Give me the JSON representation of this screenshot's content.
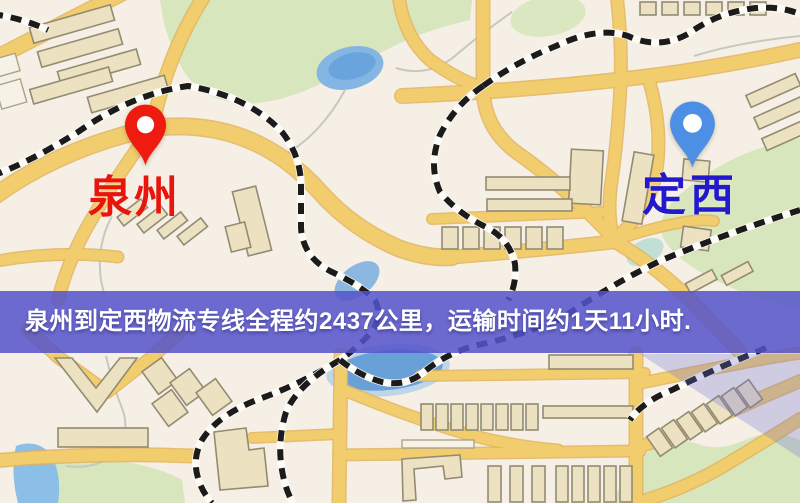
{
  "map": {
    "origin": {
      "label": "泉州"
    },
    "destination": {
      "label": "定西"
    },
    "banner": {
      "text": "泉州到定西物流专线全程约2437公里，运输时间约1天11小时."
    },
    "route": {
      "distance_text": "约2437公里",
      "duration_text": "约1天11小时"
    }
  },
  "colors": {
    "pin_origin": "#ee1c10",
    "pin_destination": "#4e8fe6",
    "label_origin": "#e8150c",
    "label_destination": "#2318cc",
    "banner_bg": "#5554cb",
    "banner_text": "#ffffff",
    "road": "#f2cd6e",
    "road_casing": "#e2b45c",
    "building": "#ece2c2",
    "building_outline": "#938b72",
    "park": "#d7e6bd",
    "water": "#84b5e3",
    "railway": "#1b1b1b",
    "map_background": "#f5efe5",
    "lavender_overlay": "#6c6ed6"
  }
}
